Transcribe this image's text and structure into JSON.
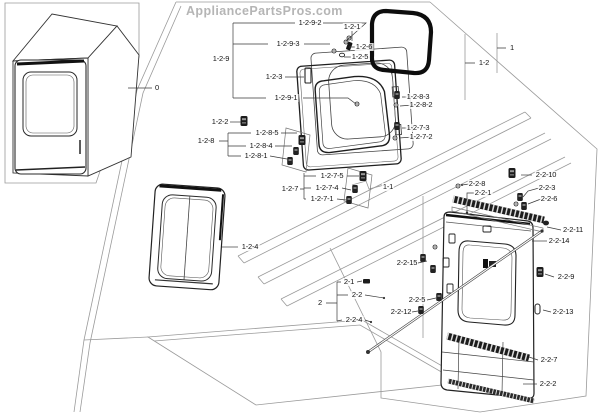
{
  "watermark": "AppliancePartsPros.com",
  "diagram": {
    "type": "exploded-parts-diagram",
    "labels": [
      {
        "text": "0",
        "x": 157,
        "y": 88
      },
      {
        "text": "1-2-9-2",
        "x": 310,
        "y": 23
      },
      {
        "text": "1-2-1",
        "x": 352,
        "y": 27
      },
      {
        "text": "1-2-6",
        "x": 364,
        "y": 47
      },
      {
        "text": "1-2-5",
        "x": 360,
        "y": 57
      },
      {
        "text": "1-2-9-3",
        "x": 288,
        "y": 44
      },
      {
        "text": "1-2-9",
        "x": 221,
        "y": 59
      },
      {
        "text": "1-2-3",
        "x": 274,
        "y": 77
      },
      {
        "text": "1-2-9-1",
        "x": 286,
        "y": 98
      },
      {
        "text": "1-2-2",
        "x": 220,
        "y": 122
      },
      {
        "text": "1-2-8",
        "x": 206,
        "y": 141
      },
      {
        "text": "1-2-8-5",
        "x": 267,
        "y": 133
      },
      {
        "text": "1-2-8-4",
        "x": 261,
        "y": 146
      },
      {
        "text": "1-2-8-1",
        "x": 256,
        "y": 156
      },
      {
        "text": "1-2-7",
        "x": 290,
        "y": 189
      },
      {
        "text": "1-2-7-5",
        "x": 332,
        "y": 176
      },
      {
        "text": "1-2-7-4",
        "x": 327,
        "y": 188
      },
      {
        "text": "1-2-7-1",
        "x": 322,
        "y": 199
      },
      {
        "text": "1-1",
        "x": 388,
        "y": 187
      },
      {
        "text": "1-2-4",
        "x": 250,
        "y": 247
      },
      {
        "text": "1",
        "x": 512,
        "y": 48
      },
      {
        "text": "1-2",
        "x": 484,
        "y": 63
      },
      {
        "text": "1-2-8-3",
        "x": 418,
        "y": 97
      },
      {
        "text": "1-2-8-2",
        "x": 421,
        "y": 105
      },
      {
        "text": "1-2-7-3",
        "x": 418,
        "y": 128
      },
      {
        "text": "1-2-7-2",
        "x": 421,
        "y": 137
      },
      {
        "text": "2-2-10",
        "x": 546,
        "y": 175
      },
      {
        "text": "2-2-8",
        "x": 477,
        "y": 184
      },
      {
        "text": "2-2-1",
        "x": 483,
        "y": 193
      },
      {
        "text": "2-2-3",
        "x": 547,
        "y": 188
      },
      {
        "text": "2-2-6",
        "x": 549,
        "y": 199
      },
      {
        "text": "2-2-11",
        "x": 573,
        "y": 230
      },
      {
        "text": "2-2-14",
        "x": 559,
        "y": 241
      },
      {
        "text": "2-2-9",
        "x": 566,
        "y": 277
      },
      {
        "text": "2-2-13",
        "x": 563,
        "y": 312
      },
      {
        "text": "2-2-7",
        "x": 549,
        "y": 360
      },
      {
        "text": "2-2-2",
        "x": 548,
        "y": 384
      },
      {
        "text": "2",
        "x": 320,
        "y": 303
      },
      {
        "text": "2-1",
        "x": 349,
        "y": 282
      },
      {
        "text": "2-2",
        "x": 357,
        "y": 295
      },
      {
        "text": "2-2-4",
        "x": 354,
        "y": 320
      },
      {
        "text": "2-2-15",
        "x": 407,
        "y": 263
      },
      {
        "text": "2-2-5",
        "x": 417,
        "y": 300
      },
      {
        "text": "2-2-12",
        "x": 401,
        "y": 312
      }
    ]
  }
}
